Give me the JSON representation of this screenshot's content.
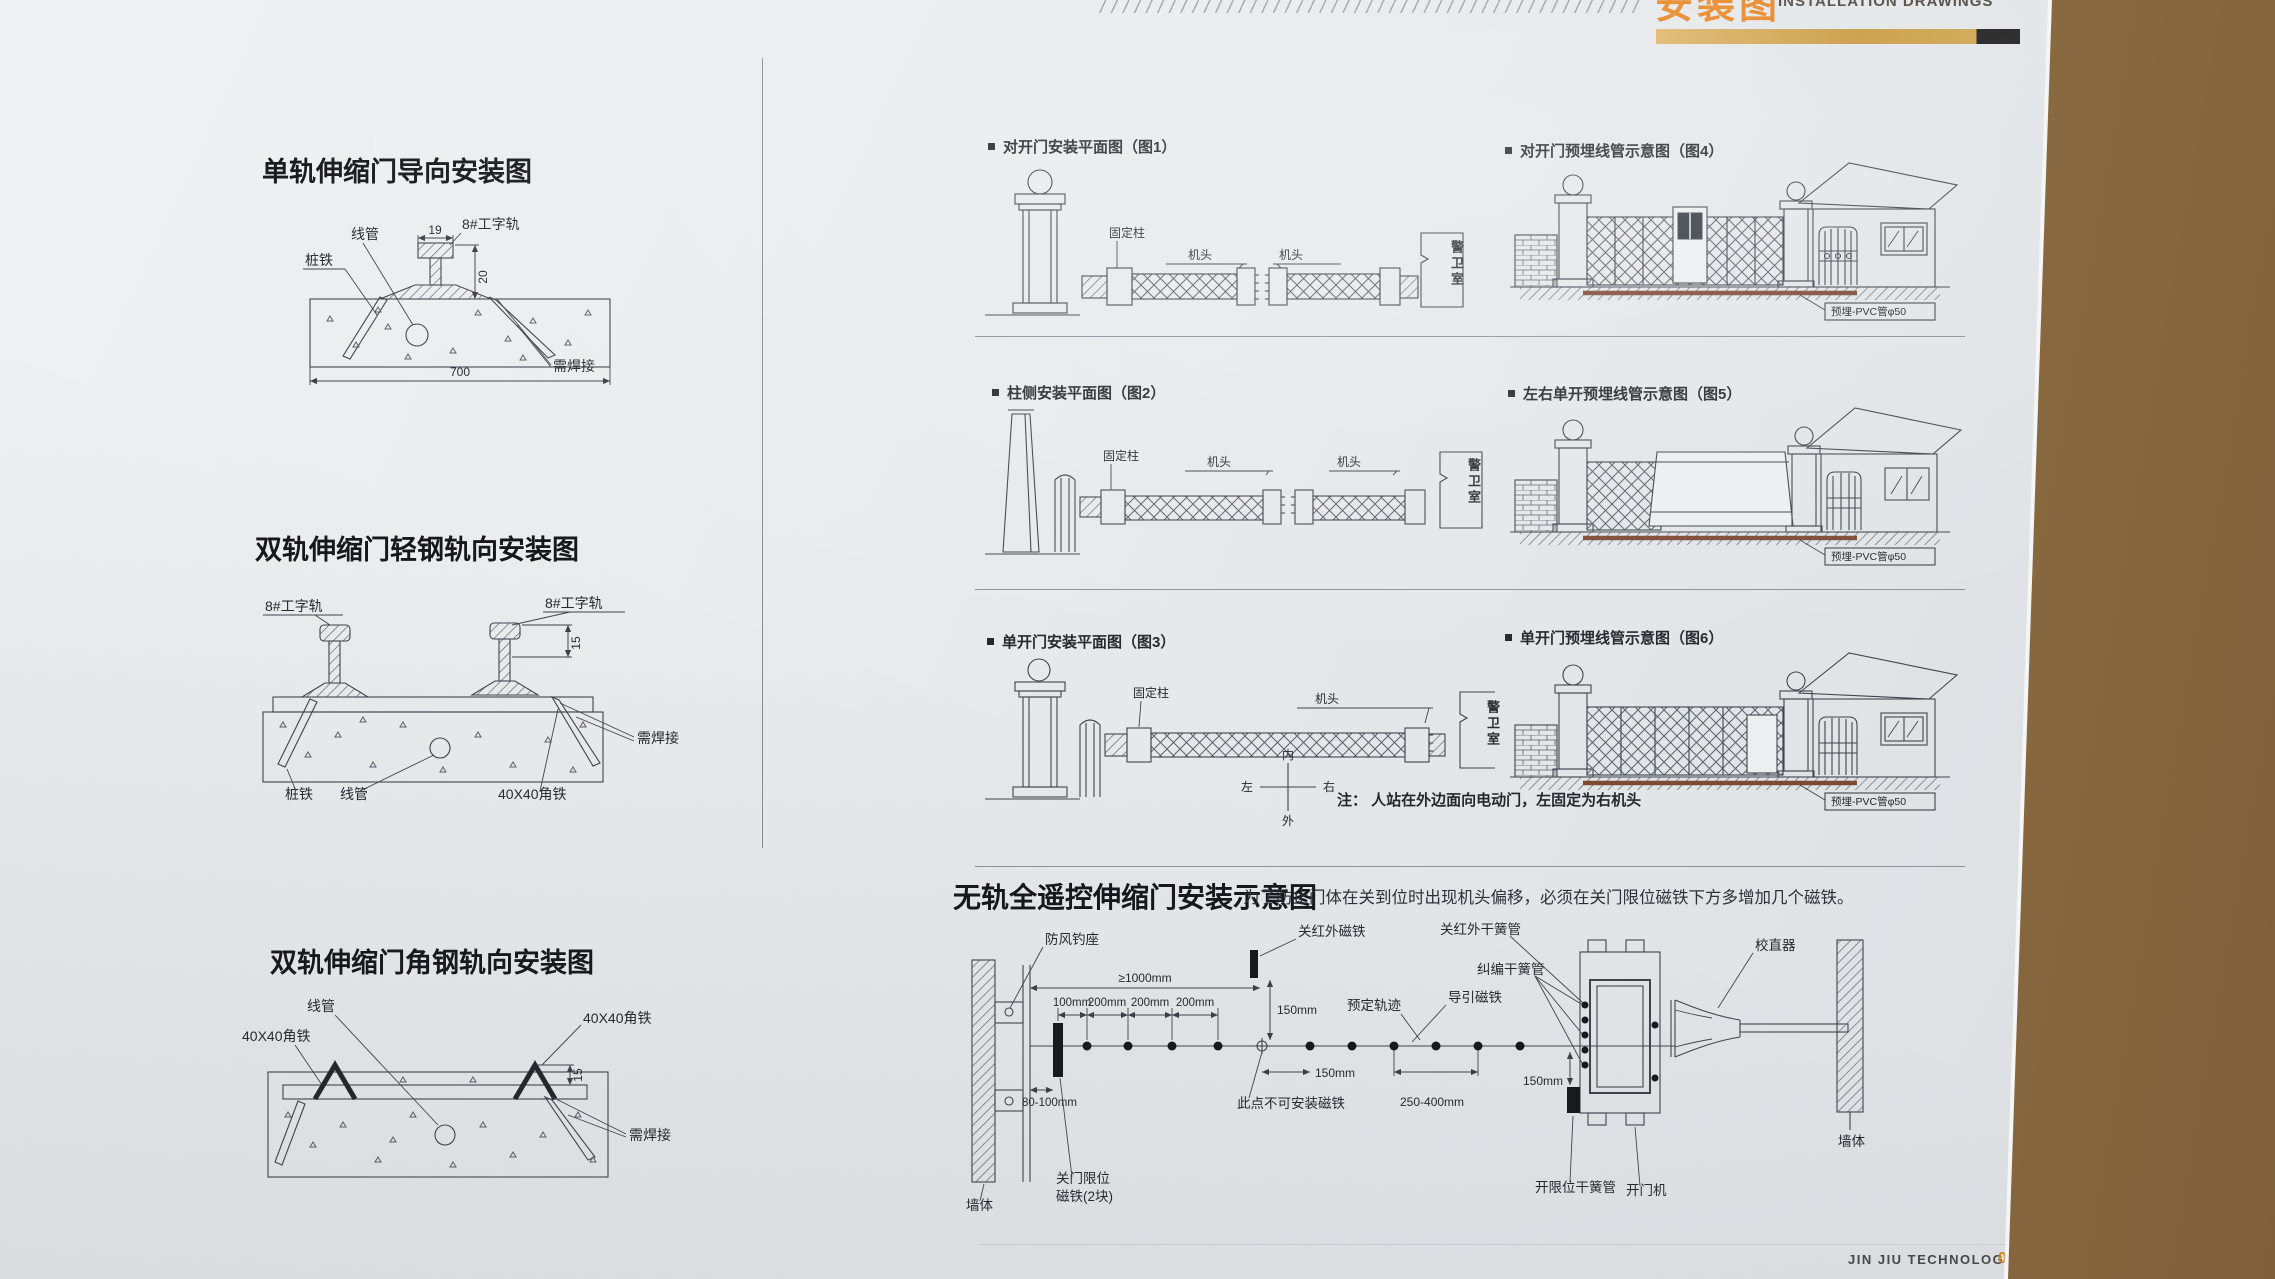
{
  "header": {
    "cn": "安装图",
    "en": "INSTALLATION DRAWINGS"
  },
  "footer": {
    "brand": "JIN JIU TECHNOLOGY",
    "num": "082"
  },
  "left": {
    "d1": {
      "title": "单轨伸缩门导向安装图",
      "conduit": "线管",
      "rail": "8#工字轨",
      "stake": "桩铁",
      "weld": "需焊接",
      "dim19": "19",
      "dim20": "20",
      "dim700": "700"
    },
    "d2": {
      "title": "双轨伸缩门轻钢轨向安装图",
      "rail": "8#工字轨",
      "dim15": "15",
      "weld": "需焊接",
      "stake": "桩铁",
      "conduit": "线管",
      "angle": "40X40角铁"
    },
    "d3": {
      "title": "双轨伸缩门角钢轨向安装图",
      "conduit": "线管",
      "angle": "40X40角铁",
      "dim15": "15",
      "weld": "需焊接"
    }
  },
  "rows": {
    "r1": {
      "plan": "对开门安装平面图（图1）",
      "pipe": "对开门预埋线管示意图（图4）",
      "fixed": "固定柱",
      "head": "机头",
      "guard": "警卫室",
      "pvc": "预埋-PVC管φ50"
    },
    "r2": {
      "plan": "柱侧安装平面图（图2）",
      "pipe": "左右单开预埋线管示意图（图5）",
      "fixed": "固定柱",
      "head": "机头",
      "guard": "警卫室",
      "pvc": "预埋-PVC管φ50"
    },
    "r3": {
      "plan": "单开门安装平面图（图3）",
      "pipe": "单开门预埋线管示意图（图6）",
      "fixed": "固定柱",
      "head": "机头",
      "guard": "警卫室",
      "pvc": "预埋-PVC管φ50",
      "compass": {
        "n": "内",
        "w": "左",
        "e": "右",
        "s": "外"
      },
      "note": "注： 人站在外边面向电动门，左固定为右机头"
    }
  },
  "tk": {
    "title": "无轨全遥控伸缩门安装示意图",
    "note": "为了防止门体在关到位时出现机头偏移，必须在关门限位磁铁下方多增加几个磁铁。",
    "wall": "墙体",
    "hook": "防风钓座",
    "ir_mag": "关红外磁铁",
    "ir_reed": "关红外干簧管",
    "corr_reed": "纠编干簧管",
    "guide_mag": "导引磁铁",
    "track": "预定轨迹",
    "straight": "校直器",
    "no_mag": "此点不可安装磁铁",
    "cl1": "关门限位",
    "cl2": "磁铁(2块)",
    "open_reed": "开限位干簧管",
    "opener": "开门机",
    "d1000": "≥1000mm",
    "d100": "100mm",
    "d200": "200mm",
    "d150": "150mm",
    "d250": "250-400mm",
    "d80": "80-100mm"
  }
}
